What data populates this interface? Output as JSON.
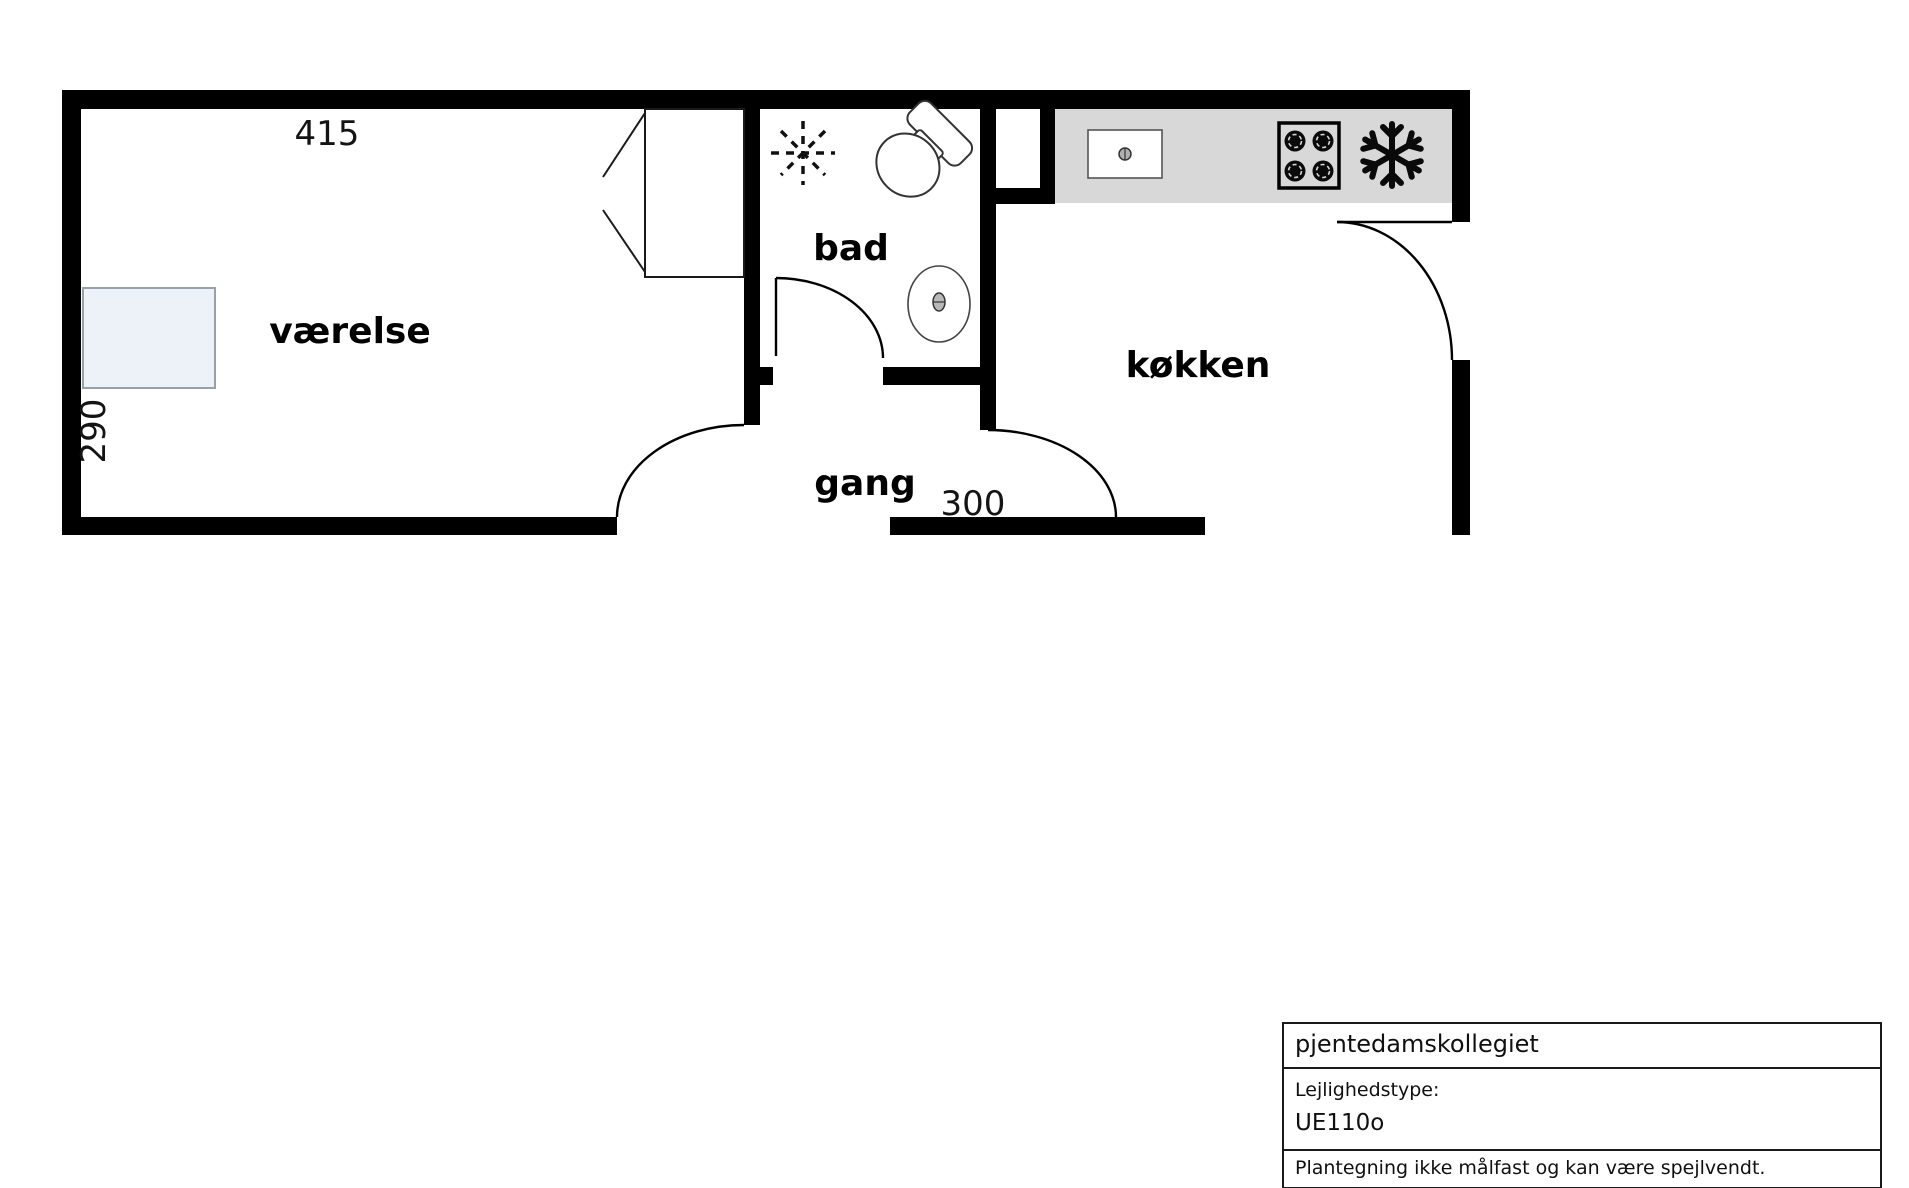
{
  "floorplan": {
    "room_labels": {
      "vaerelse": "værelse",
      "bad": "bad",
      "gang": "gang",
      "koekken": "køkken"
    },
    "dimensions": {
      "room_width_cm": "415",
      "room_depth_cm": "290",
      "kitchen_width_cm": "300"
    },
    "icons": {
      "shower": "dashed-star",
      "toilet": "toilet-tank-and-bowl",
      "bath_sink": "oval-basin",
      "kitchen_sink": "rect-basin-with-drain",
      "stove": "four-burner-hob",
      "freezer": "snowflake"
    }
  },
  "info_box": {
    "title": "pjentedamskollegiet",
    "type_label": "Lejlighedstype:",
    "type_value": "UE110o",
    "disclaimer": "Plantegning ikke målfast og kan være spejlvendt."
  },
  "colors": {
    "wall": "#000000",
    "countertop": "#d8d8d8",
    "furniture_fill": "#edf2f8",
    "furniture_border": "#97a1ac",
    "line": "#000000"
  }
}
